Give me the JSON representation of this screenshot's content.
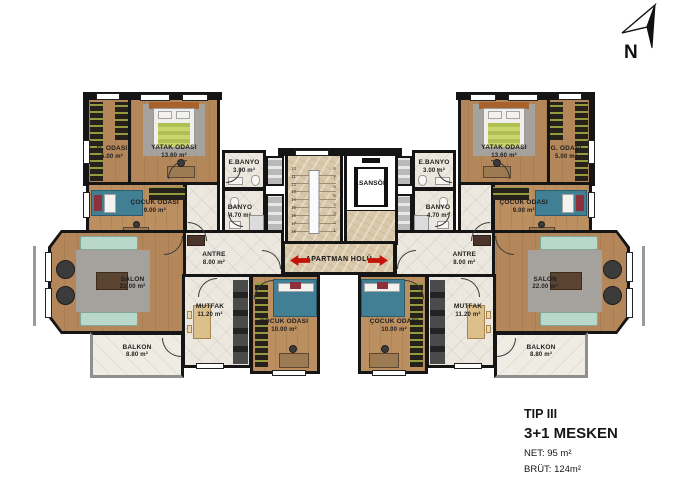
{
  "plan": {
    "rooms": {
      "yatak": {
        "name": "YATAK ODASI",
        "area": "13.60 m²"
      },
      "godasi": {
        "name": "G. ODASI",
        "area": "5.00 m²"
      },
      "cocuk9": {
        "name": "ÇOCUK ODASI",
        "area": "9.00 m²"
      },
      "ebanyo": {
        "name": "E.BANYO",
        "area": "3.00 m²"
      },
      "banyo": {
        "name": "BANYO",
        "area": "4.70 m²"
      },
      "antre": {
        "name": "ANTRE",
        "area": "8.00 m²"
      },
      "salon": {
        "name": "SALON",
        "area": "22.00 m²"
      },
      "mutfak": {
        "name": "MUTFAK",
        "area": "11.20 m²"
      },
      "cocuk10": {
        "name": "ÇOCUK ODASI",
        "area": "10.00 m²"
      },
      "balkon": {
        "name": "BALKON",
        "area": "8.80 m²"
      }
    },
    "core": {
      "elevator": "ASANSÖR",
      "hall": "APARTMAN HOLÜ",
      "stairs_left_numbers": [
        "10",
        "11",
        "12",
        "13",
        "14",
        "15",
        "16",
        "17",
        "18"
      ],
      "stairs_right_numbers": [
        "8",
        "7",
        "6",
        "5",
        "4",
        "3",
        "2",
        "1"
      ]
    }
  },
  "north_arrow": {
    "label": "N"
  },
  "title_block": {
    "type": "TIP III",
    "unit": "3+1 MESKEN",
    "net": "NET: 95 m²",
    "brut": "BRÜT: 124m²"
  },
  "colors": {
    "wall": "#151515",
    "wood_floor": "#b3875a",
    "tile_floor": "#ece8df",
    "marble_floor": "#d9c8a9",
    "entry_arrow_red": "#c41309",
    "sofa_teal": "#b9d7ca",
    "kid_bed_blue": "#417f95"
  }
}
